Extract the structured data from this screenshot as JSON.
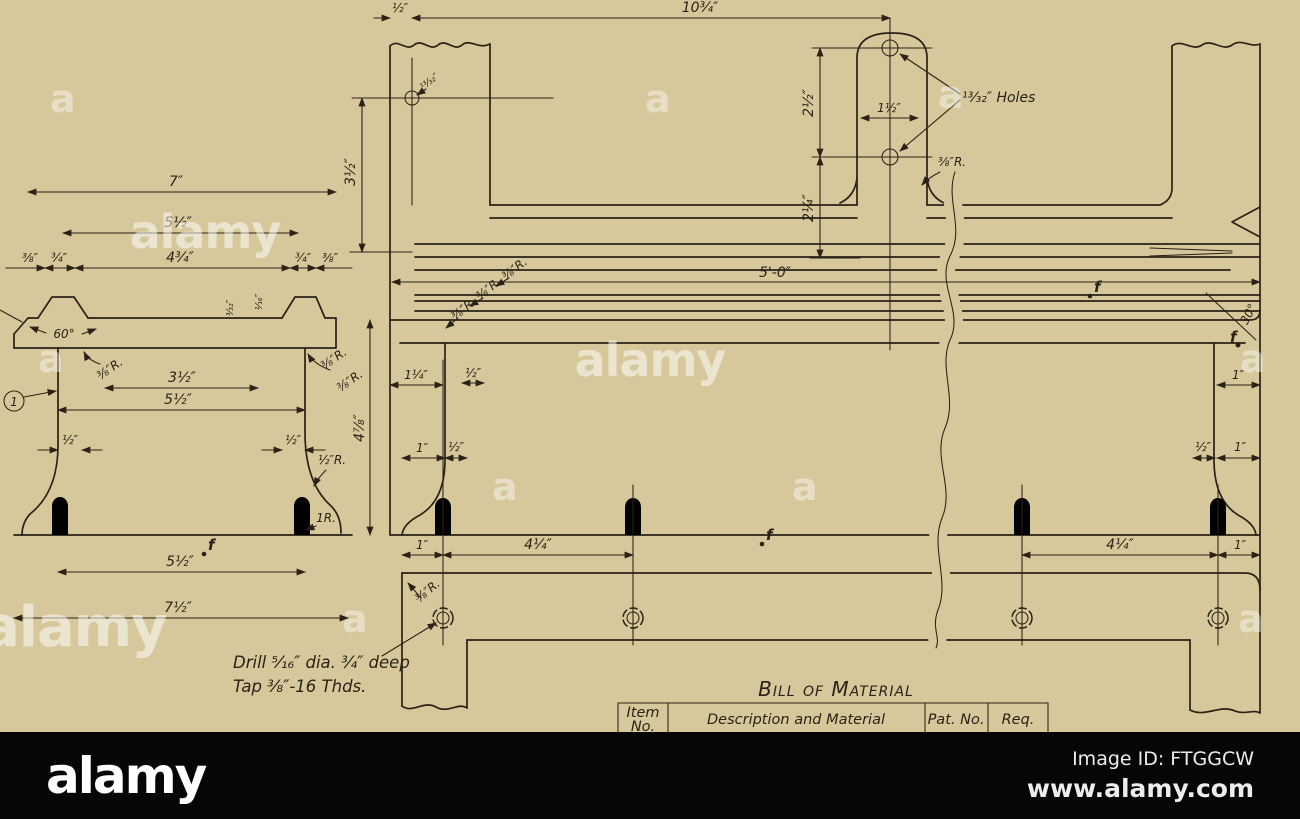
{
  "image": {
    "width": 1300,
    "height": 819
  },
  "colors": {
    "paper": "#d7c89c",
    "ink": "#292215",
    "bar_bg": "#060606"
  },
  "watermark": {
    "word": "alamy",
    "letter": "a"
  },
  "footer": {
    "logo": "alamy",
    "image_id": "Image ID: FTGGCW",
    "url": "www.alamy.com"
  },
  "bom": {
    "title": "Bill of Material",
    "header_item_line1": "Item",
    "header_item_line2": "No.",
    "header_description": "Description and Material",
    "header_pat_no": "Pat. No.",
    "header_req": "Req."
  },
  "section_view": {
    "dim_width_overall": "7″",
    "dim_way_span": "5½″",
    "dim_way_centers": "4¾″",
    "dim_edge_left": "⅜″",
    "dim_way_left": "¾″",
    "dim_way_right": "¾″",
    "dim_edge_right": "⅜″",
    "angle_vway": "60°",
    "radius_web_left": "⅜″R.",
    "radius_web_right": "⅜″R.",
    "radius_web_right2": "⅜″R.",
    "dim_web_inner": "3½″",
    "dim_web_outer": "5½″",
    "dim_web_thickness_left": "½″",
    "dim_web_thickness_right": "½″",
    "radius_flare": "½″R.",
    "radius_base": "1R.",
    "dim_detail_a": "³⁄₃₂″",
    "dim_detail_b": "¹⁄₁₆″",
    "dim_height": "4⅞″",
    "dim_base_centers": "5½″",
    "dim_base_overall": "7½″",
    "balloon_item": "1"
  },
  "elevation_view": {
    "dim_end_offset": "½″",
    "dim_hole_span": "10¾″",
    "hole_size_left": "¹³⁄₃₂″",
    "dim_bracket_holes": "2½″",
    "dim_bracket_width": "1½″",
    "note_holes": "¹³⁄₃₂″ Holes",
    "radius_bracket": "⅜″R.",
    "dim_bracket_base": "2¼″",
    "dim_hole_height": "3½″",
    "radius_corner_1": "⅜″R.",
    "radius_corner_2": "⅜″R.",
    "radius_corner_3": "⅜″R.",
    "dim_length": "5'-0″",
    "dim_web_offset": "1¼″",
    "dim_web_thk_top": "½″",
    "dim_foot_left": "1″",
    "dim_web_thk": "½″",
    "dim_foot_hole": "1″",
    "dim_hole_spacing_left": "4¼″",
    "dim_hole_spacing_right": "4¼″",
    "dim_foot_hole_right": "1″",
    "dim_right_top": "1″",
    "dim_right_web_thk": "½″",
    "dim_right_web": "1″",
    "angle_end": "30°",
    "radius_foot": "⅜″R.",
    "finish_mark": "f"
  },
  "notes": {
    "drill_line1": "Drill ⁵⁄₁₆″ dia. ¾″ deep",
    "drill_line2": "Tap ⅜″-16 Thds."
  }
}
